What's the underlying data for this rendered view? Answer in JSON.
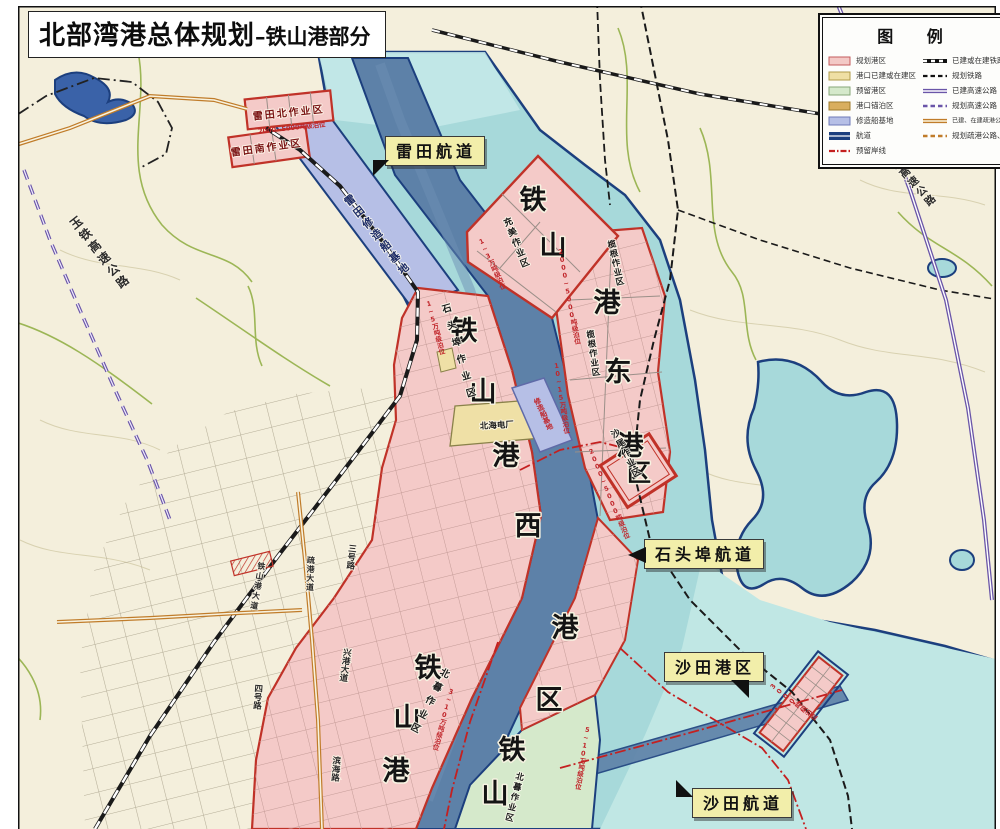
{
  "title": {
    "main": "北部湾港总体规划",
    "sub": "–铁山港部分"
  },
  "legend": {
    "title": "图 例",
    "area_items": [
      {
        "label": "规划港区",
        "color": "#f3c9c6",
        "border": "#c45c5c"
      },
      {
        "label": "港口已建或在建区",
        "color": "#efdfa4",
        "border": "#b09b4a"
      },
      {
        "label": "预留港区",
        "color": "#d5e9cb",
        "border": "#86a878"
      },
      {
        "label": "港口锚泊区",
        "color": "#d9ae5e",
        "border": "#9e7c2c"
      },
      {
        "label": "修造船基地",
        "color": "#b6bfe6",
        "border": "#6f7ab8"
      },
      {
        "label": "航道",
        "color": "#1c3f7e"
      },
      {
        "label": "预留岸线",
        "color": "#c42020"
      }
    ],
    "line_items": [
      {
        "label": "已建或在建铁路"
      },
      {
        "label": "规划铁路"
      },
      {
        "label": "已建高速公路"
      },
      {
        "label": "规划高速公路"
      },
      {
        "label": "已建、在建疏港公路和道路"
      },
      {
        "label": "规划疏港公路、道路"
      }
    ]
  },
  "colors": {
    "land": "#f4efdc",
    "water": "#a7d9da",
    "water_light": "#c0e7e4",
    "river_top": "#c6e9e9",
    "channel": "#5d81a8",
    "channel_border": "#1c3f7e",
    "pink": "#f4cac8",
    "pink_border": "#c03228",
    "yellow": "#efe0a6",
    "yellow_border": "#8a824a",
    "green": "#d5e9cb",
    "lavender": "#b6bfe6",
    "railway": "#1a1a1a",
    "expressway": "#6a55a8",
    "road_orange": "#c07c2a",
    "reserved_line": "#c42020",
    "stream": "#9cb656",
    "contour": "#d8d1b0",
    "lake": "#3a62a8"
  },
  "callouts": {
    "leitian": "雷田航道",
    "shitoubu": "石头埠航道",
    "shatian_port": "沙田港区",
    "shatian": "沙田航道"
  },
  "big_labels": {
    "ne": [
      "铁",
      "山"
    ],
    "east": [
      "港",
      "东",
      "港",
      "区"
    ],
    "west": [
      "铁",
      "山",
      "港",
      "西",
      "港",
      "区"
    ],
    "southwest": [
      "铁",
      "山",
      "港"
    ],
    "south": [
      "铁",
      "山"
    ]
  },
  "area_labels": {
    "leitian_north": "雷田北作业区",
    "leitian_south": "雷田南作业区",
    "leitian_shipyard": "雷田修造船基地",
    "chongmei": "充美作业区",
    "langen_a": "榄根作业区",
    "langen_b": "榄根作业区",
    "shawei": "沙尾作业区",
    "shitoubu": "石头埠作业区",
    "beimu_west": "北暮作业区",
    "beimu_south": "北暮作业区",
    "power_plant": "北海电厂",
    "shipyard_strip": "修造船基地"
  },
  "road_labels": {
    "yutie": "玉铁高速公路",
    "coastal": "沿海高速公路",
    "shugang": "疏港大道",
    "tsg_avenue": "铁山港大道",
    "road3": "三号路",
    "road4": "四号路",
    "xinggang": "兴港大道",
    "binhai": "滨海路"
  },
  "berth_labels": [
    "2000~5000吨级泊位",
    "1~5万吨级泊位",
    "1~3万吨级泊位",
    "2000~5000吨级泊位",
    "10~15万吨级泊位",
    "2000~5000吨级泊位",
    "3~10万吨级泊位",
    "5~10万吨级泊位",
    "3000吨级泊位"
  ]
}
